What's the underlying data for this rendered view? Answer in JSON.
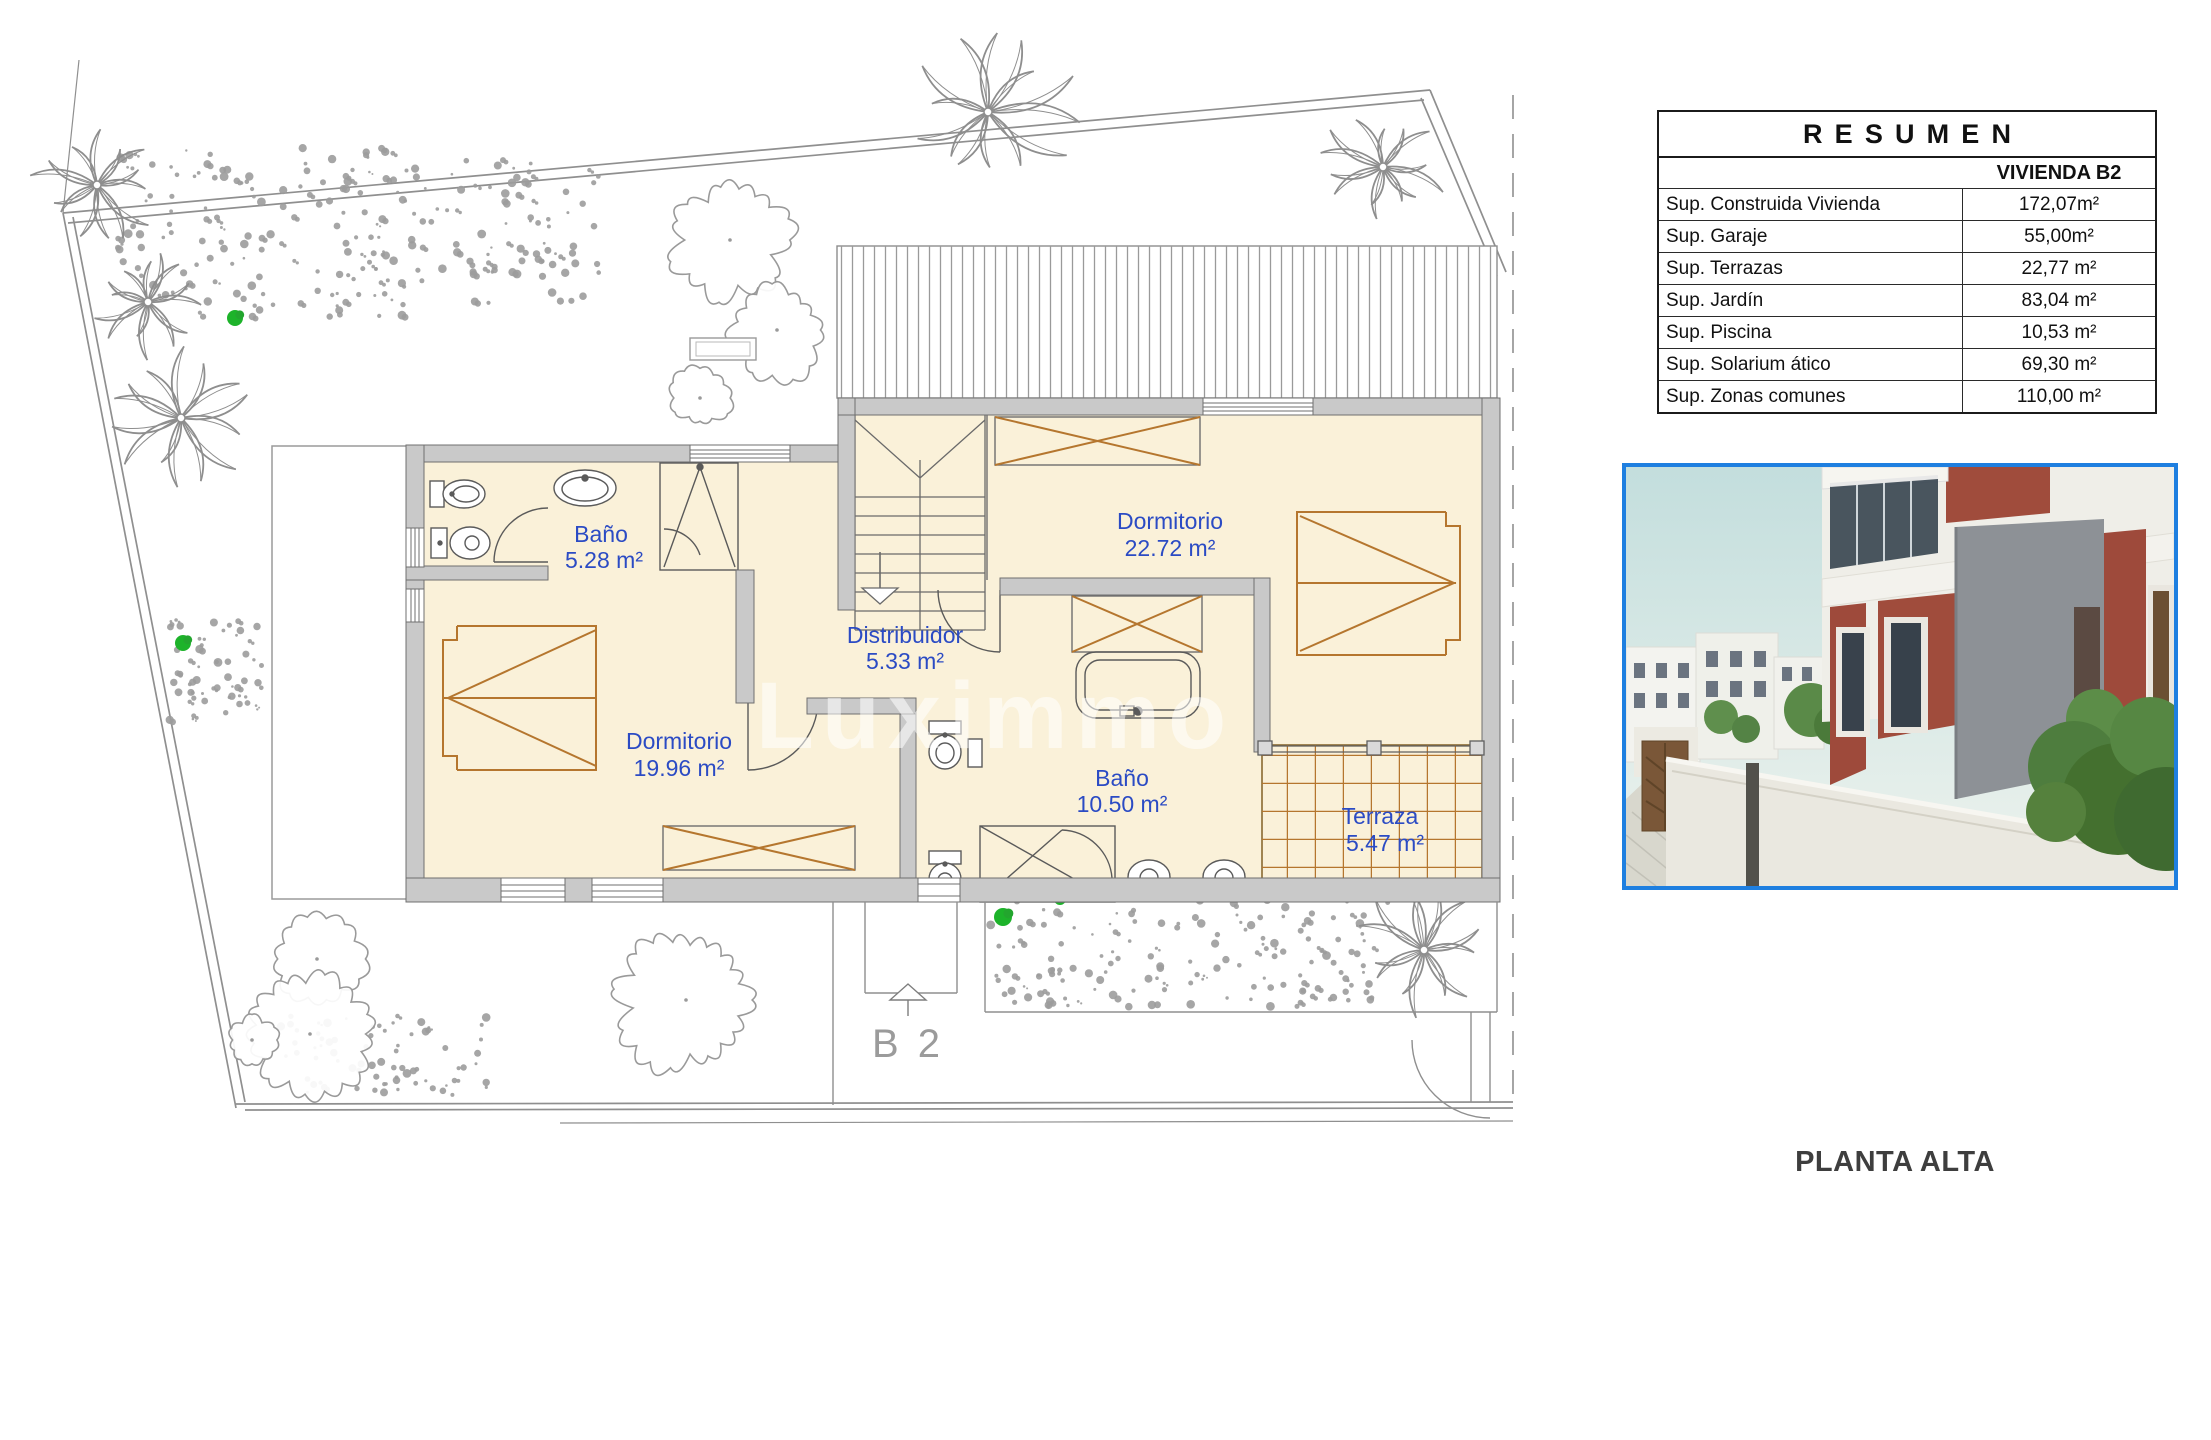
{
  "plan": {
    "rooms": [
      {
        "name": "Baño",
        "area": "5.28 m²"
      },
      {
        "name": "Distribuidor",
        "area": "5.33 m²"
      },
      {
        "name": "Dormitorio",
        "area": "22.72 m²"
      },
      {
        "name": "Dormitorio",
        "area": "19.96 m²"
      },
      {
        "name": "Baño",
        "area": "10.50 m²"
      },
      {
        "name": "Terraza",
        "area": "5.47 m²"
      }
    ],
    "unit_label": "B 2",
    "floor_title": "PLANTA ALTA",
    "watermark": "Luximmo"
  },
  "summary_table": {
    "title": "RESUMEN",
    "unit_header": "VIVIENDA B2",
    "rows": [
      {
        "label": "Sup. Construida Vivienda",
        "value": "172,07m²"
      },
      {
        "label": "Sup. Garaje",
        "value": "55,00m²"
      },
      {
        "label": "Sup. Terrazas",
        "value": "22,77 m²"
      },
      {
        "label": "Sup. Jardín",
        "value": "83,04 m²"
      },
      {
        "label": "Sup. Piscina",
        "value": "10,53 m²"
      },
      {
        "label": "Sup. Solarium ático",
        "value": "69,30 m²"
      },
      {
        "label": "Sup. Zonas comunes",
        "value": "110,00 m²"
      }
    ]
  },
  "colors": {
    "label_blue": "#2B4BC4",
    "floor_fill": "#FAF1D9",
    "wall_fill": "#C9C9C9",
    "wood_accent": "#B5762E",
    "photo_border": "#1E7FE0"
  }
}
